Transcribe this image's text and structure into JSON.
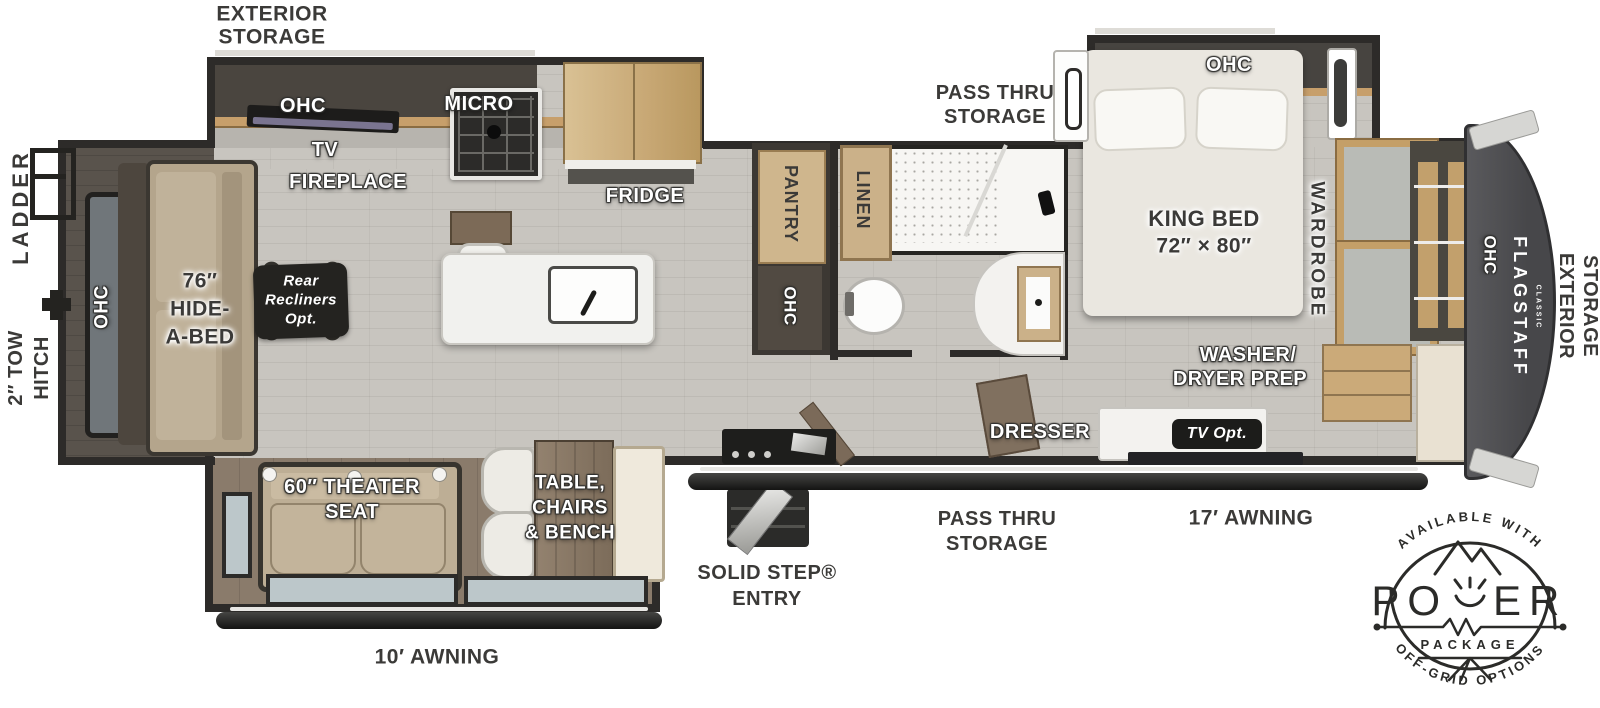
{
  "colors": {
    "wall": "#2d2b29",
    "floor": "#c8c5bf",
    "slide_floor_brown": "#8a7b6b",
    "wood_tan": "#c9a977",
    "label_dark": "#3b3a38",
    "badge_ink": "#2b2b29",
    "cap_gray": "#4d4d50"
  },
  "labels": {
    "exterior_storage_top_line1": "EXTERIOR",
    "exterior_storage_top_line2": "STORAGE",
    "ladder": "LADDER",
    "tow_hitch_line1": "2″ TOW",
    "tow_hitch_line2": "HITCH",
    "ohc_rear": "OHC",
    "hide_a_bed_line1": "76″",
    "hide_a_bed_line2": "HIDE-",
    "hide_a_bed_line3": "A-BED",
    "rear_recliners_line1": "Rear",
    "rear_recliners_line2": "Recliners",
    "rear_recliners_line3": "Opt.",
    "ohc_kitchen": "OHC",
    "micro": "MICRO",
    "tv": "TV",
    "fireplace": "FIREPLACE",
    "fridge": "FRIDGE",
    "pantry": "PANTRY",
    "ohc_pantry": "OHC",
    "linen": "LINEN",
    "pass_thru_top_line1": "PASS THRU",
    "pass_thru_top_line2": "STORAGE",
    "ohc_bedroom": "OHC",
    "king_bed_line1": "KING BED",
    "king_bed_line2": "72″ × 80″",
    "wardrobe": "WARDROBE",
    "washer_dryer_line1": "WASHER/",
    "washer_dryer_line2": "DRYER PREP",
    "dresser": "DRESSER",
    "tv_opt": "TV Opt.",
    "ohc_front": "OHC",
    "exterior_storage_right_line1": "EXTERIOR",
    "exterior_storage_right_line2": "STORAGE",
    "theater_seat_line1": "60″ THEATER",
    "theater_seat_line2": "SEAT",
    "dinette_line1": "TABLE,",
    "dinette_line2": "CHAIRS",
    "dinette_line3": "& BENCH",
    "awning_left": "10′ AWNING",
    "awning_right": "17′ AWNING",
    "solid_step_line1": "SOLID STEP®",
    "solid_step_line2": "ENTRY",
    "pass_thru_bottom_line1": "PASS THRU",
    "pass_thru_bottom_line2": "STORAGE"
  },
  "brand": {
    "name": "FLAGSTAFF",
    "sub": "CLASSIC"
  },
  "badge": {
    "arc_top": "AVAILABLE WITH",
    "power_left": "PO",
    "power_right": "ER",
    "package": "PACKAGE",
    "arc_bottom": "OFF-GRID OPTIONS"
  }
}
